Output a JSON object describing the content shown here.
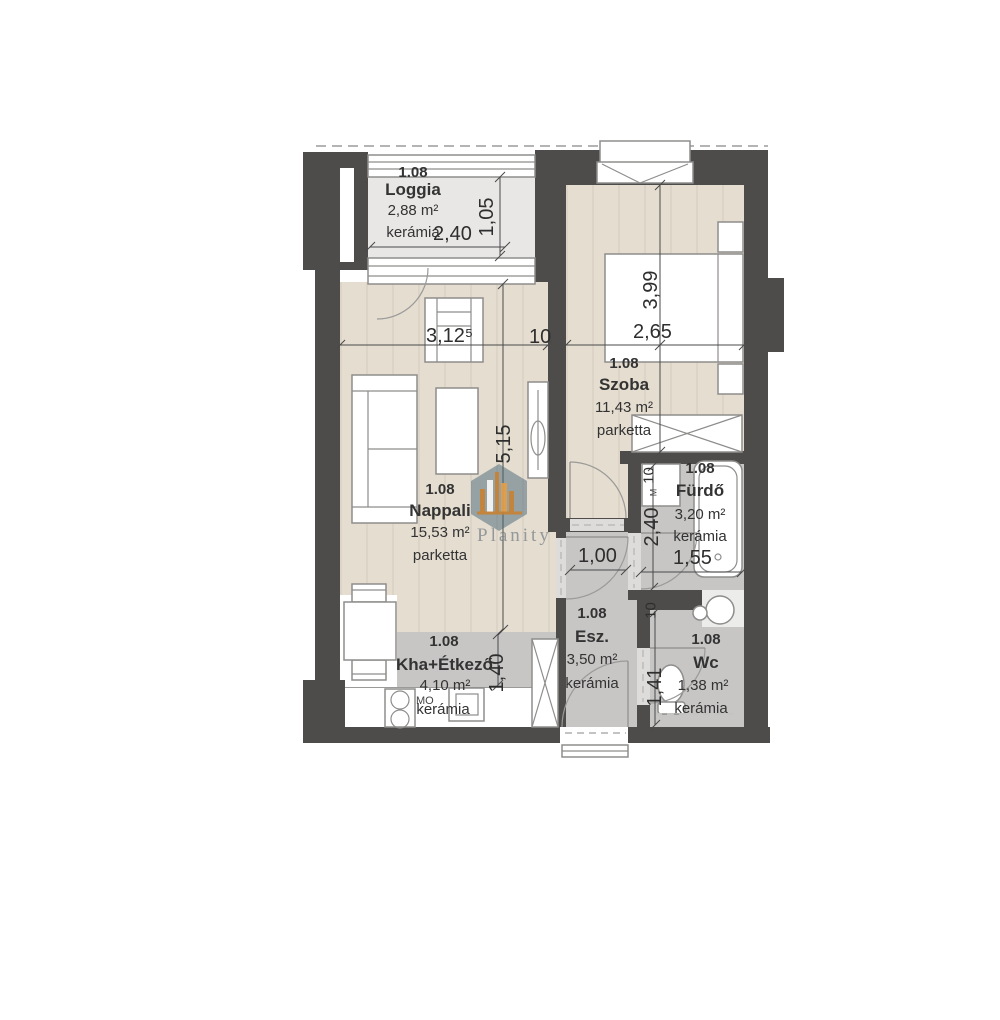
{
  "watermark": {
    "brand": "Planity"
  },
  "rooms": {
    "loggia": {
      "number": "1.08",
      "name": "Loggia",
      "area": "2,88 m²",
      "material": "kerámia"
    },
    "nappali": {
      "number": "1.08",
      "name": "Nappali",
      "area": "15,53 m²",
      "material": "parketta"
    },
    "szoba": {
      "number": "1.08",
      "name": "Szoba",
      "area": "11,43 m²",
      "material": "parketta"
    },
    "furdo": {
      "number": "1.08",
      "name": "Fürdő",
      "area": "3,20 m²",
      "material": "kerámia"
    },
    "esz": {
      "number": "1.08",
      "name": "Esz.",
      "area": "3,50 m²",
      "material": "kerámia"
    },
    "wc": {
      "number": "1.08",
      "name": "Wc",
      "area": "1,38 m²",
      "material": "kerámia"
    },
    "kha": {
      "number": "1.08",
      "name": "Kha+Étkező",
      "area": "4,10 m²",
      "material": "kerámia"
    }
  },
  "dimensions": {
    "loggia_width": "2,40",
    "loggia_depth": "1,05",
    "nappali_width": "3,12⁵",
    "nappali_depth": "5,15",
    "wall_top": "10",
    "szoba_width": "2,65",
    "szoba_depth": "3,99",
    "hall_door_width": "1,00",
    "furdo_width": "1,55",
    "furdo_depth": "2,40",
    "furdo_wall": "10",
    "esz_wall": "10",
    "wc_depth": "1,41",
    "kha_depth": "1,40"
  },
  "appliances": {
    "washer": "M",
    "sink": "MO"
  },
  "colors": {
    "wall": "#4d4c4a",
    "parquet": "#e4ddd0",
    "ceramic": "#c7c6c5",
    "loggia_floor": "#e8e7e5"
  }
}
